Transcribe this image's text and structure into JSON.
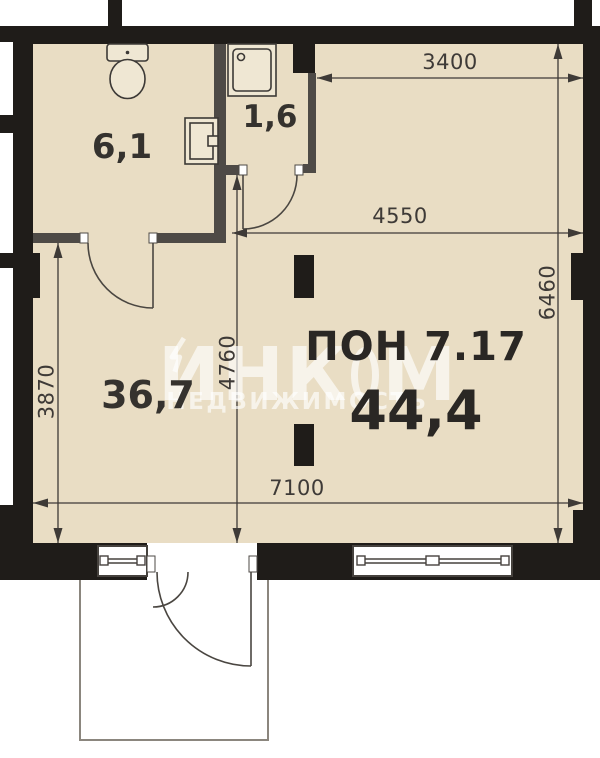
{
  "plan": {
    "unit": {
      "label": "ПОН 7.17",
      "total_area": "44,4"
    },
    "rooms": {
      "bathroom": {
        "area": "6,1"
      },
      "shower": {
        "area": "1,6"
      },
      "living": {
        "area": "36,7"
      }
    },
    "dimensions": {
      "top_width": "3400",
      "middle_width": "4550",
      "bottom_width": "7100",
      "left_height": "3870",
      "center_height": "4760",
      "right_height": "6460"
    },
    "watermark": {
      "brand_prefix": "ИНК",
      "brand_suffix": "М",
      "subtitle": "НЕДВИЖИМОСТЬ"
    },
    "colors": {
      "floor": "#e9ddc4",
      "outer_wall": "#1f1c19",
      "partition_wall": "#4e4a46",
      "dimension": "#3e3a37",
      "watermark": "rgba(255,255,255,0.65)"
    }
  }
}
